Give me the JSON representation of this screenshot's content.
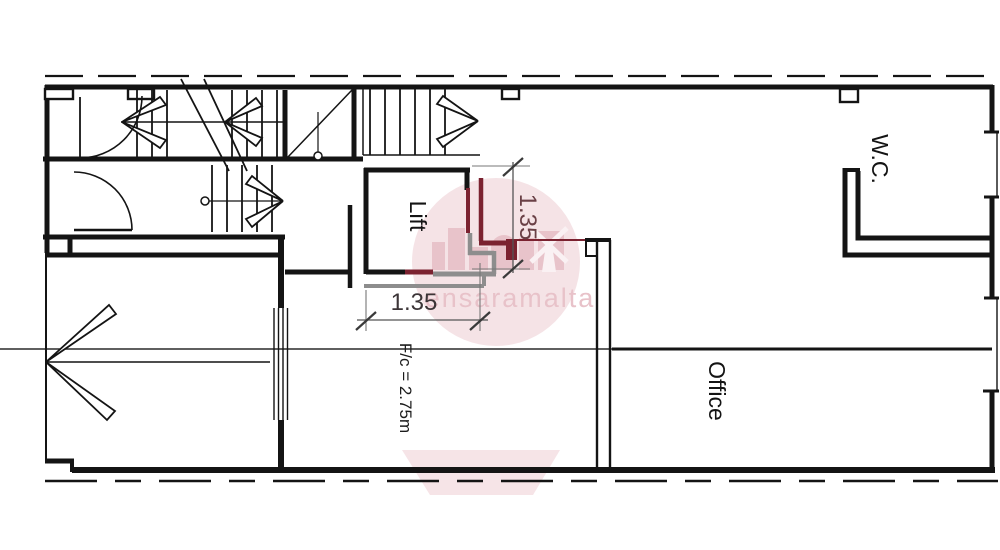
{
  "plan": {
    "type": "floor-plan",
    "labels": {
      "lift": "Lift",
      "wc": "W.C.",
      "office": "Office",
      "ceiling_height": "F/c = 2.75m"
    },
    "dimensions": {
      "horizontal_width": "1.35",
      "vertical_width": "1.35"
    },
    "watermark": {
      "text": "ensaramalta",
      "logo": "windmill-badge"
    },
    "colors": {
      "wall_black": "#141414",
      "proposed_wall_red": "#7b2230",
      "existing_wall_gray": "#8d8d8d",
      "dim_text_dark": "#3c3537",
      "dim_text_red": "#6a4046",
      "watermark_pink": "#e8c2c9",
      "background": "#ffffff"
    }
  }
}
